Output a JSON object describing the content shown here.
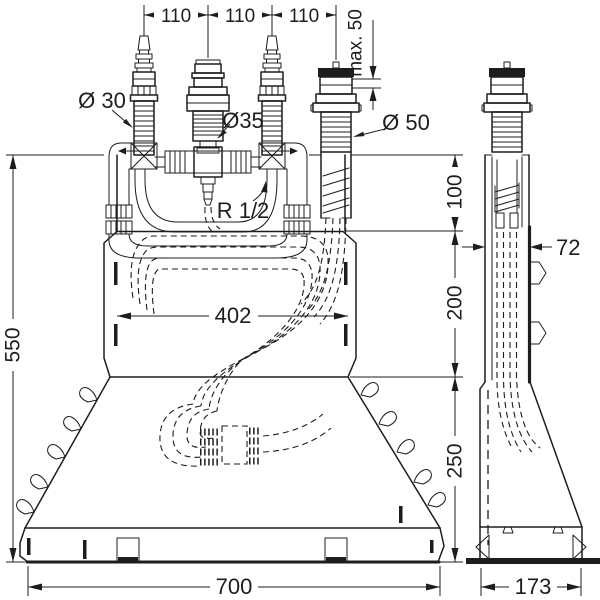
{
  "dimensions": {
    "top_spacing": [
      "110",
      "110",
      "110"
    ],
    "max_height": "max. 50",
    "total_height": "550",
    "height_upper": "100",
    "height_middle": "200",
    "height_lower": "250",
    "inner_width": "402",
    "total_width": "700",
    "side_depth": "72",
    "base_depth": "173"
  },
  "labels": {
    "handle_diameter": "Ø 30",
    "diverter_diameter": "Ø35",
    "spout_diameter": "Ø 50",
    "thread_size": "R 1/2"
  },
  "colors": {
    "line": "#1d1d1b",
    "background": "#ffffff"
  }
}
